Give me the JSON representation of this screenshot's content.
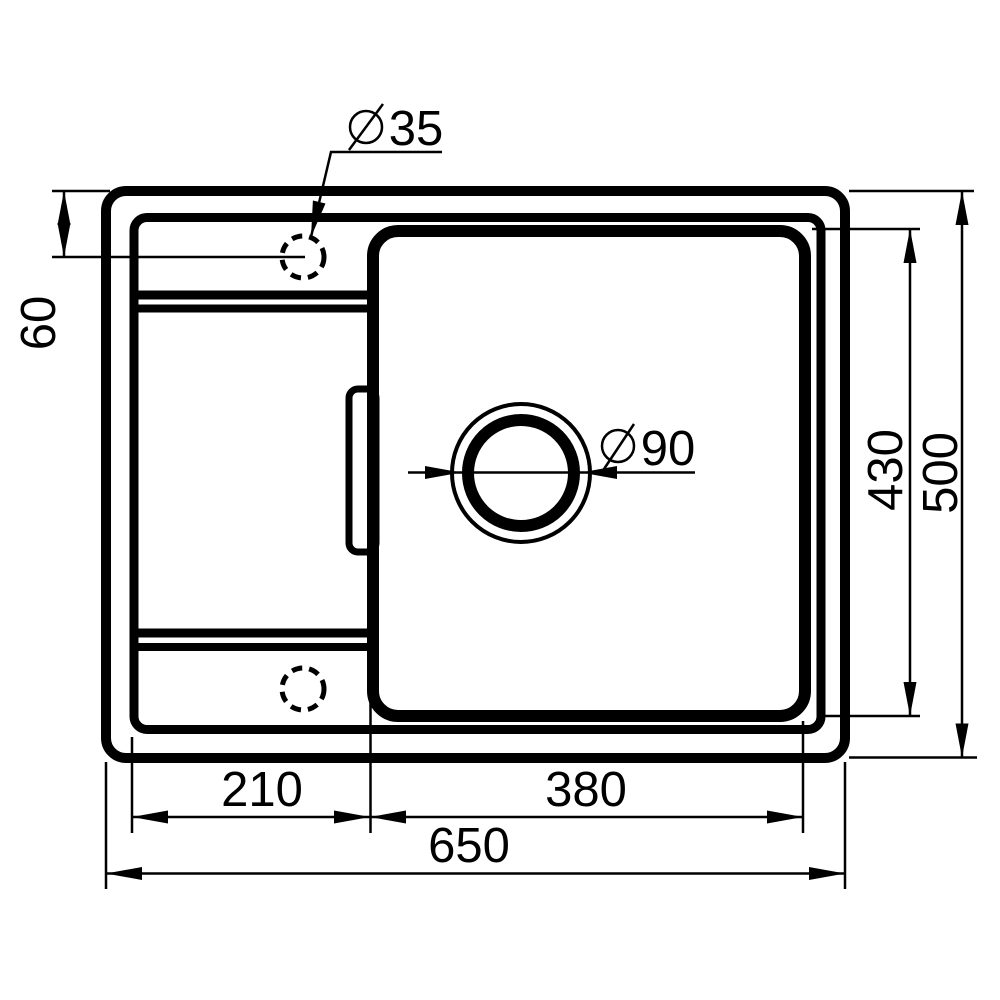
{
  "drawing": {
    "type": "technical-dimension-drawing",
    "subject": "kitchen-sink-top-view",
    "background_color": "#ffffff",
    "line_color": "#000000",
    "icons": {
      "diameter_symbol": "circle-with-slash"
    },
    "labels": {
      "faucet_hole_diameter": "35",
      "drain_diameter": "90",
      "faucet_offset": "60",
      "bowl_length": "430",
      "overall_depth": "500",
      "drainer_width": "210",
      "bowl_width": "380",
      "overall_width": "650"
    }
  }
}
